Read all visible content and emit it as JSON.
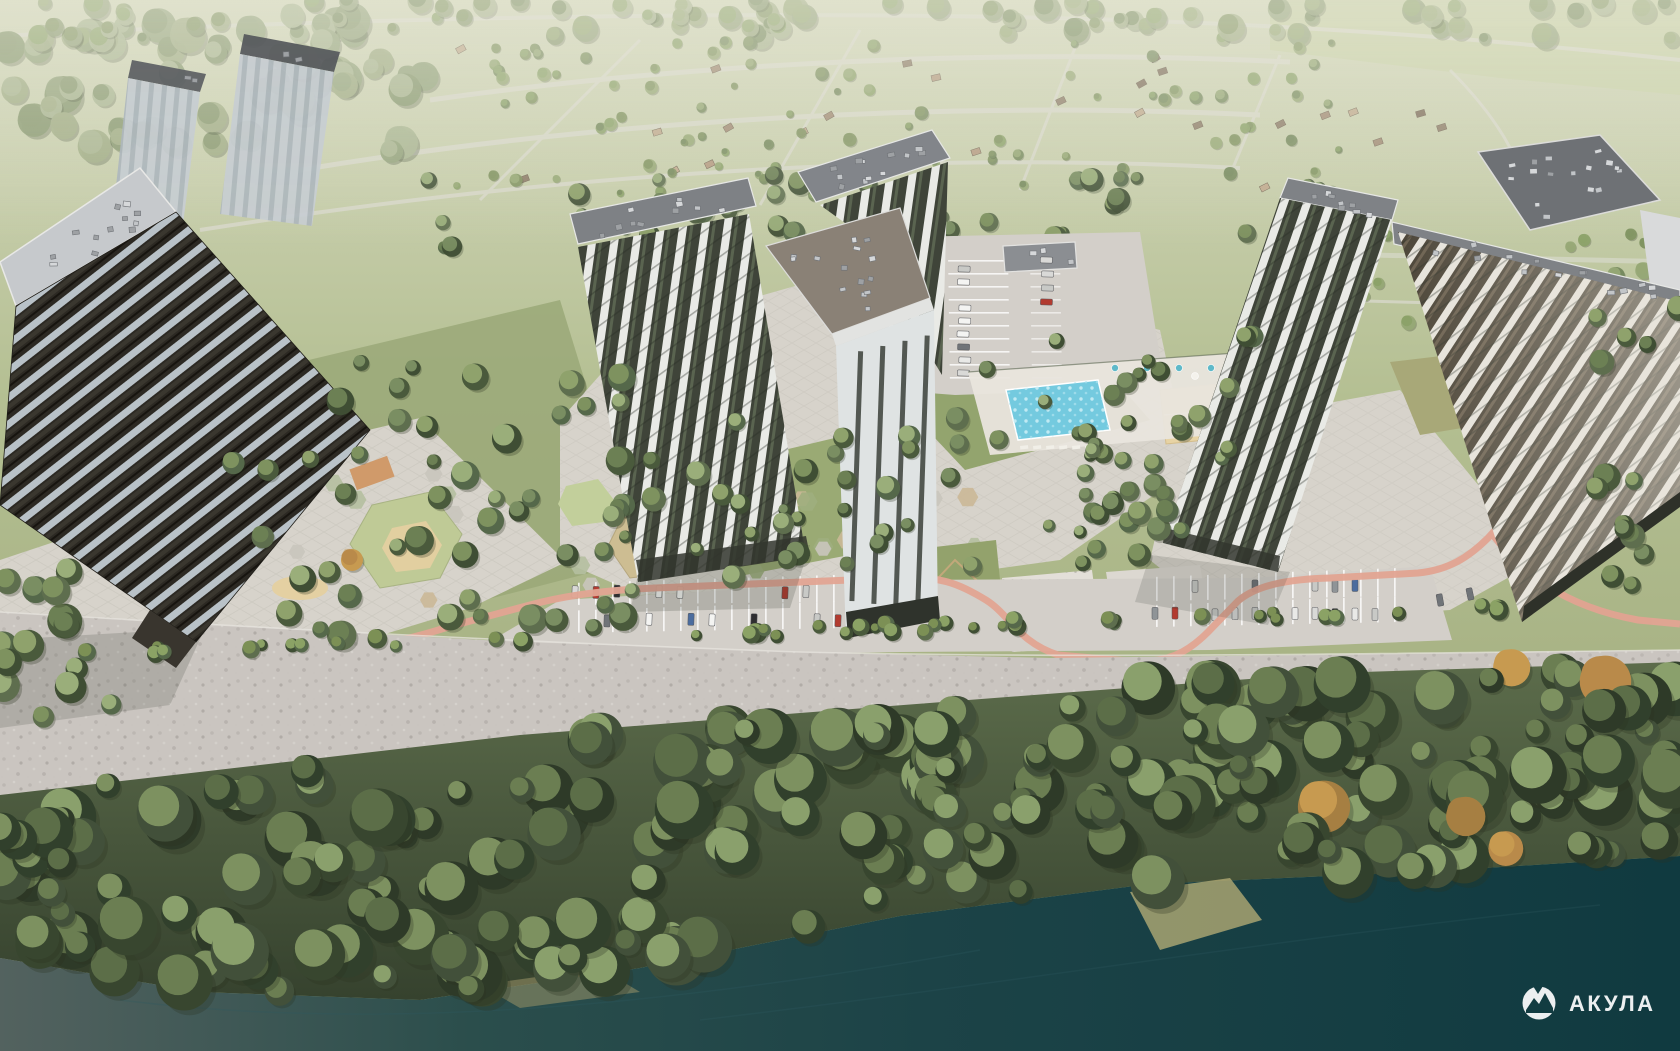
{
  "watermark": {
    "brand": "АКУЛА",
    "icon": "shark-mountain-logo"
  },
  "scene": {
    "type": "aerial-architectural-render",
    "description": "Aerial 3D rendering of a riverside residential complex: five striped high-rise towers, landscaped courtyards with pool, playgrounds and sports courts, parking lots with a salmon bike lane, a gravel promenade, a dense forest strip and a dark teal river; suburban cottage plots fade into haze at the top"
  },
  "palette": {
    "background_top": "#d3d7bb",
    "background_mid": "#b4bf92",
    "background_low": "#a3ae80",
    "field_top_right": "#c8d0a6",
    "haze": "#eaeadb",
    "road_light": "#dcdad1",
    "water_left": "#53625f",
    "water_mid": "#1c4347",
    "water_right": "#103a40",
    "khaki_bank": "#b1aa74",
    "forest_grad_top": "#5c6c4b",
    "forest_grad_bottom": "#36422e",
    "promenade": "#cac5c0",
    "paving": "#d7d3cb",
    "lawn": "#97a673",
    "pool": "#74cadf",
    "pool_dots": "#c9eef5",
    "sand": "#e7d3a4",
    "bike_path": "#e2a492",
    "asphalt": "#d3cfc9",
    "facade_white": "#e9eae6",
    "facade_dark_green": "#3f4439",
    "facade_dark_brown": "#4a4336",
    "dark_tower_band_light": "#b9c2c8",
    "dark_tower_dark": "#2c2923",
    "roof_gray": "#7e8185",
    "roof_dark": "#6b6e72",
    "roof_brown": "#8a8176",
    "parapet": "#dcdcda",
    "watermark_white": "#ffffff",
    "tree_greens_dark": [
      "#4a5a3c",
      "#55684a",
      "#3f4e34",
      "#5e6e4e"
    ],
    "tree_greens_light": [
      "#7e925f",
      "#8fa26c",
      "#6c8054",
      "#9aae7a",
      "#7a8e62"
    ],
    "forest_dark": [
      "#2e3a28",
      "#38462f",
      "#42503a",
      "#31402c"
    ],
    "forest_light": [
      "#5c6e48",
      "#6b7e52",
      "#7d9160",
      "#8aa06c"
    ],
    "haze_greens": [
      "#93a37c",
      "#a0ad85",
      "#87986f",
      "#aab692"
    ],
    "suburb_greens": [
      "#7f925f",
      "#8ba268",
      "#74885c",
      "#97a876"
    ],
    "autumn": [
      "#b98a4a",
      "#c79a50",
      "#a67f42"
    ],
    "car_colors": [
      "#f4f4f2",
      "#e9e9e7",
      "#2e2e30",
      "#8f9497",
      "#b23b30",
      "#4b6c9e",
      "#d9d9d7",
      "#707478",
      "#c8c9c6"
    ],
    "cottage_roofs": [
      "#a08a74",
      "#7d6c5a",
      "#b49a80",
      "#8d7c68",
      "#c0aa8e"
    ]
  }
}
